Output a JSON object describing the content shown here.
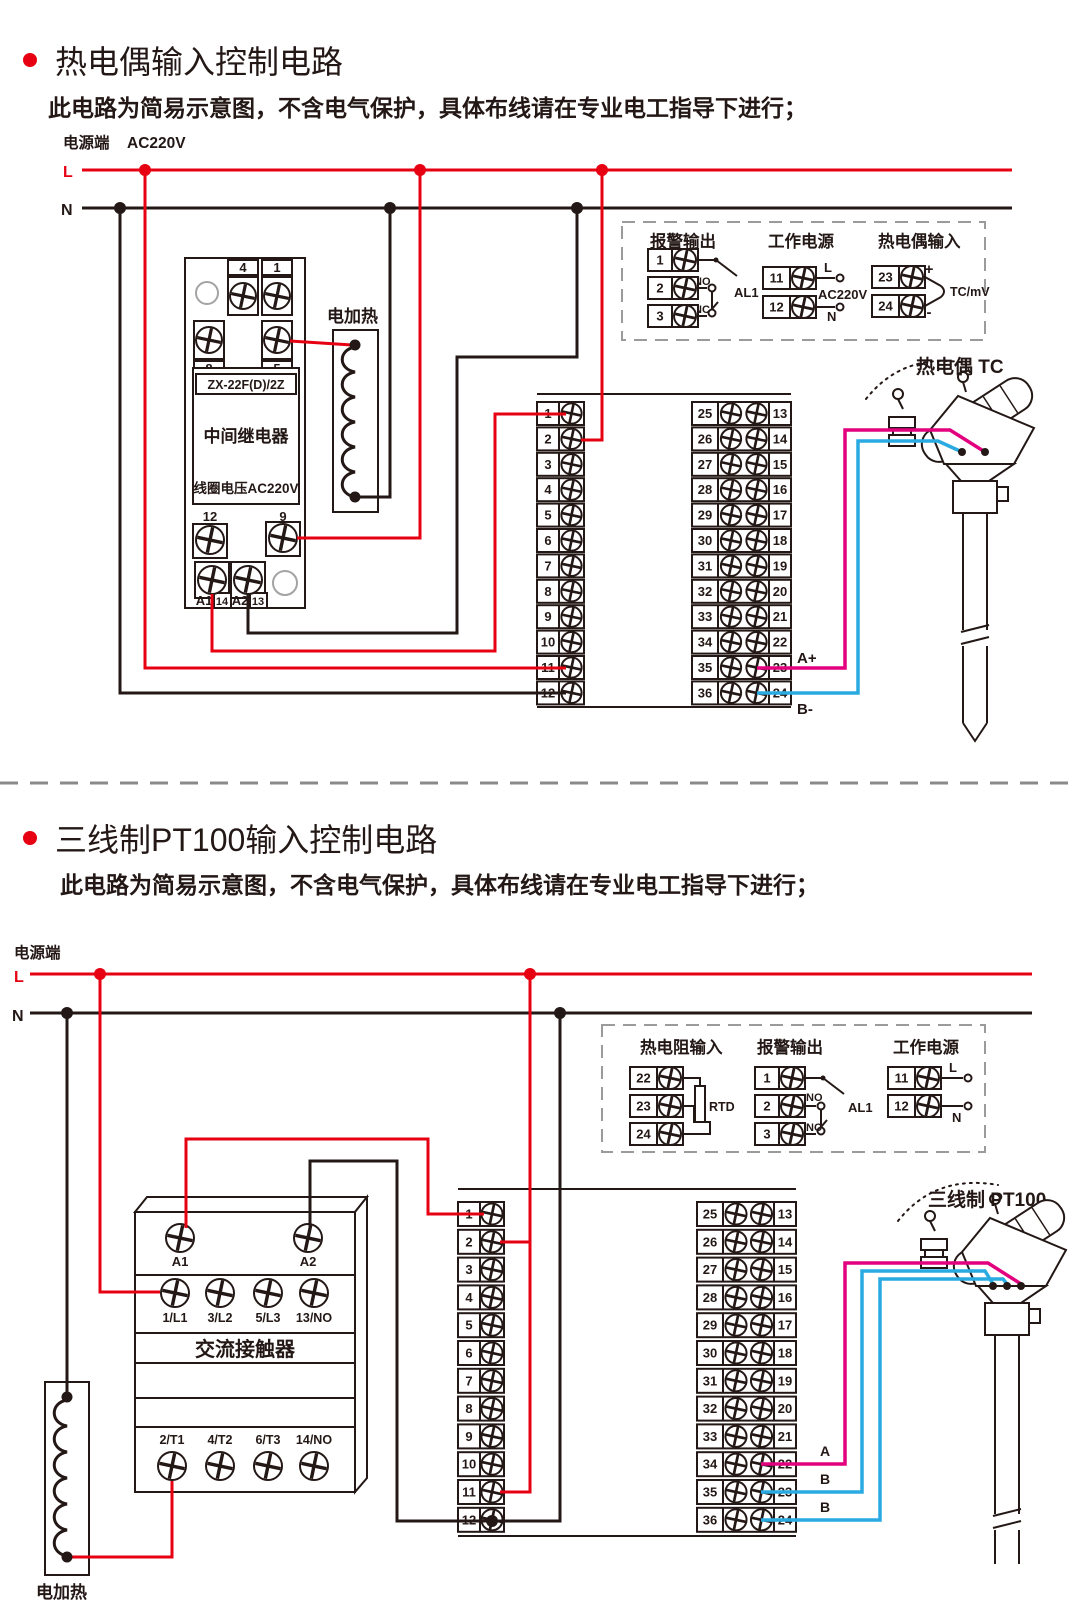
{
  "colors": {
    "red": "#e60012",
    "black": "#231815",
    "magenta": "#e3007f",
    "blue": "#29abe2"
  },
  "section1": {
    "title": "热电偶输入控制电路",
    "subtitle": "此电路为简易示意图，不含电气保护，具体布线请在专业电工指导下进行；",
    "power_label": "电源端",
    "voltage": "AC220V",
    "l": "L",
    "n": "N",
    "heater_label": "电加热",
    "relay": {
      "model": "ZX-22F(D)/2Z",
      "name": "中间继电器",
      "coil_voltage": "线圈电压AC220V",
      "terminals_top": [
        "4",
        "1"
      ],
      "terminals_top2": [
        "8",
        "5"
      ],
      "terminals_mid": [
        "12",
        "9"
      ],
      "terminals_bottom": [
        "A1",
        "14",
        "A2",
        "13"
      ]
    },
    "legend": {
      "alarm": {
        "title": "报警输出",
        "terminals": [
          "1",
          "2",
          "3"
        ],
        "no": "NO",
        "nc": "NC",
        "name": "AL1"
      },
      "power": {
        "title": "工作电源",
        "terminals": [
          "11",
          "12"
        ],
        "l": "L",
        "voltage": "AC220V",
        "n": "N"
      },
      "input": {
        "title": "热电偶输入",
        "terminals": [
          "23",
          "24"
        ],
        "plus": "+",
        "minus": "-",
        "signal": "TC/mV"
      }
    },
    "strip": {
      "left": [
        "1",
        "2",
        "3",
        "4",
        "5",
        "6",
        "7",
        "8",
        "9",
        "10",
        "11",
        "12"
      ],
      "inner": [
        "25",
        "26",
        "27",
        "28",
        "29",
        "30",
        "31",
        "32",
        "33",
        "34",
        "35",
        "36"
      ],
      "outer": [
        "13",
        "14",
        "15",
        "16",
        "17",
        "18",
        "19",
        "20",
        "21",
        "22",
        "23",
        "24"
      ]
    },
    "wire_a": "A+",
    "wire_b": "B-",
    "sensor_label": "热电偶 TC"
  },
  "section2": {
    "title": "三线制PT100输入控制电路",
    "subtitle": "此电路为简易示意图，不含电气保护，具体布线请在专业电工指导下进行；",
    "power_label": "电源端",
    "l": "L",
    "n": "N",
    "heater_label": "电加热",
    "contactor": {
      "coil_terminals": [
        "A1",
        "A2"
      ],
      "row_top": [
        "1/L1",
        "3/L2",
        "5/L3",
        "13/NO"
      ],
      "name": "交流接触器",
      "row_bottom": [
        "2/T1",
        "4/T2",
        "6/T3",
        "14/NO"
      ]
    },
    "legend": {
      "input": {
        "title": "热电阻输入",
        "terminals": [
          "22",
          "23",
          "24"
        ],
        "name": "RTD"
      },
      "alarm": {
        "title": "报警输出",
        "terminals": [
          "1",
          "2",
          "3"
        ],
        "no": "NO",
        "nc": "NC",
        "name": "AL1"
      },
      "power": {
        "title": "工作电源",
        "terminals": [
          "11",
          "12"
        ],
        "l": "L",
        "n": "N"
      }
    },
    "strip": {
      "left": [
        "1",
        "2",
        "3",
        "4",
        "5",
        "6",
        "7",
        "8",
        "9",
        "10",
        "11",
        "12"
      ],
      "inner": [
        "25",
        "26",
        "27",
        "28",
        "29",
        "30",
        "31",
        "32",
        "33",
        "34",
        "35",
        "36"
      ],
      "outer": [
        "13",
        "14",
        "15",
        "16",
        "17",
        "18",
        "19",
        "20",
        "21",
        "22",
        "23",
        "24"
      ]
    },
    "wire_labels": [
      "A",
      "B",
      "B"
    ],
    "sensor_label": "三线制 PT100"
  }
}
